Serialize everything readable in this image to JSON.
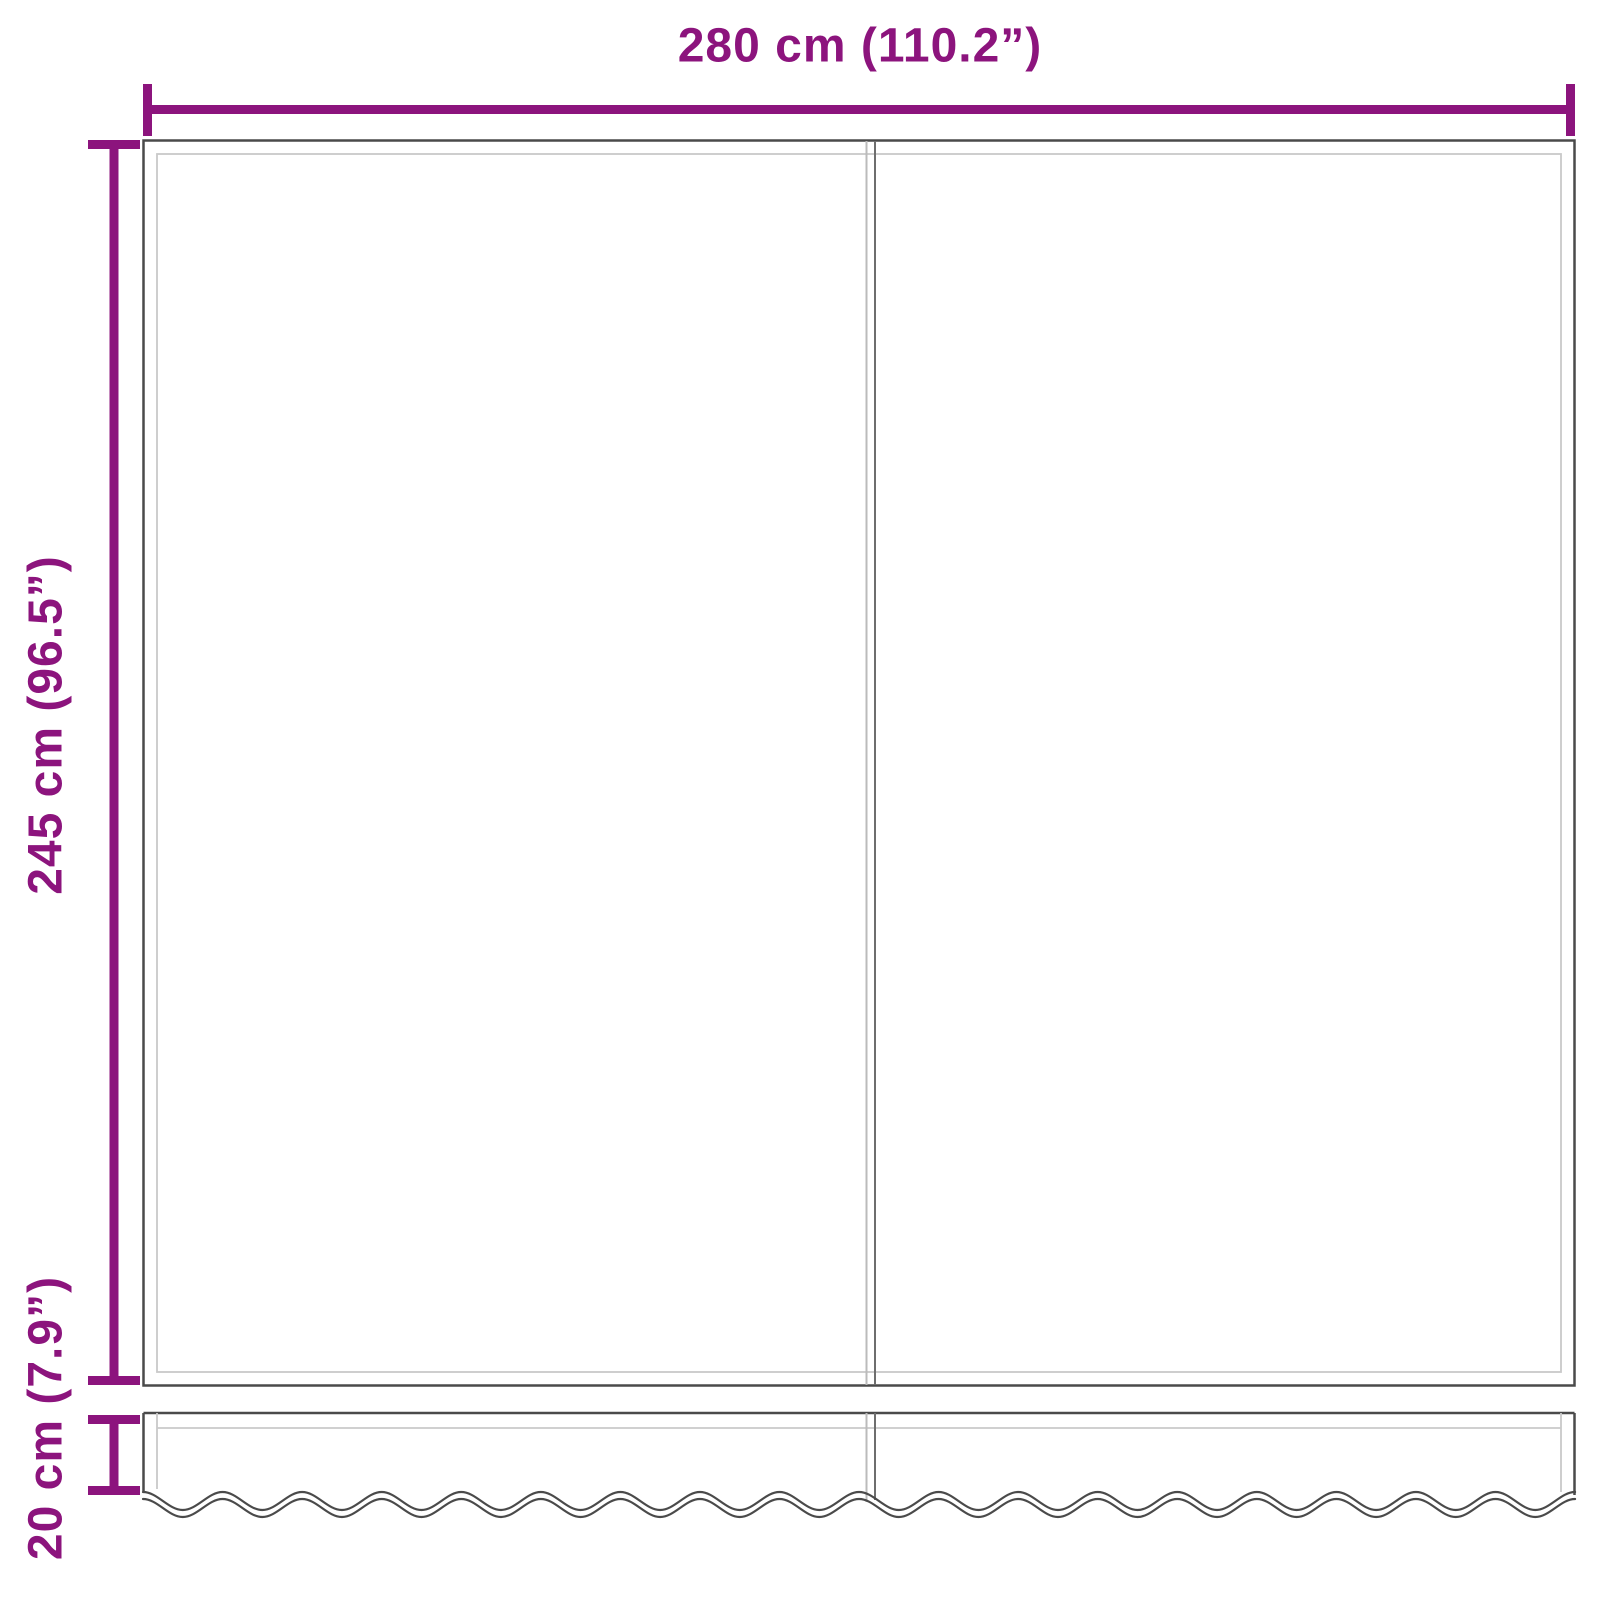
{
  "diagram": {
    "type": "awning-replacement-fabric-dimension-diagram",
    "labels": {
      "width": "280 cm (110.2”)",
      "height": "245 cm (96.5”)",
      "valance_height": "20 cm (7.9”)"
    },
    "colors": {
      "accent": "#8C147D",
      "outline": "#4A4A4A",
      "inner_line": "#C9C9C9",
      "seam_light": "#BBBBBB",
      "seam_dark": "#6E6E6E",
      "background": "#FFFFFF"
    }
  }
}
